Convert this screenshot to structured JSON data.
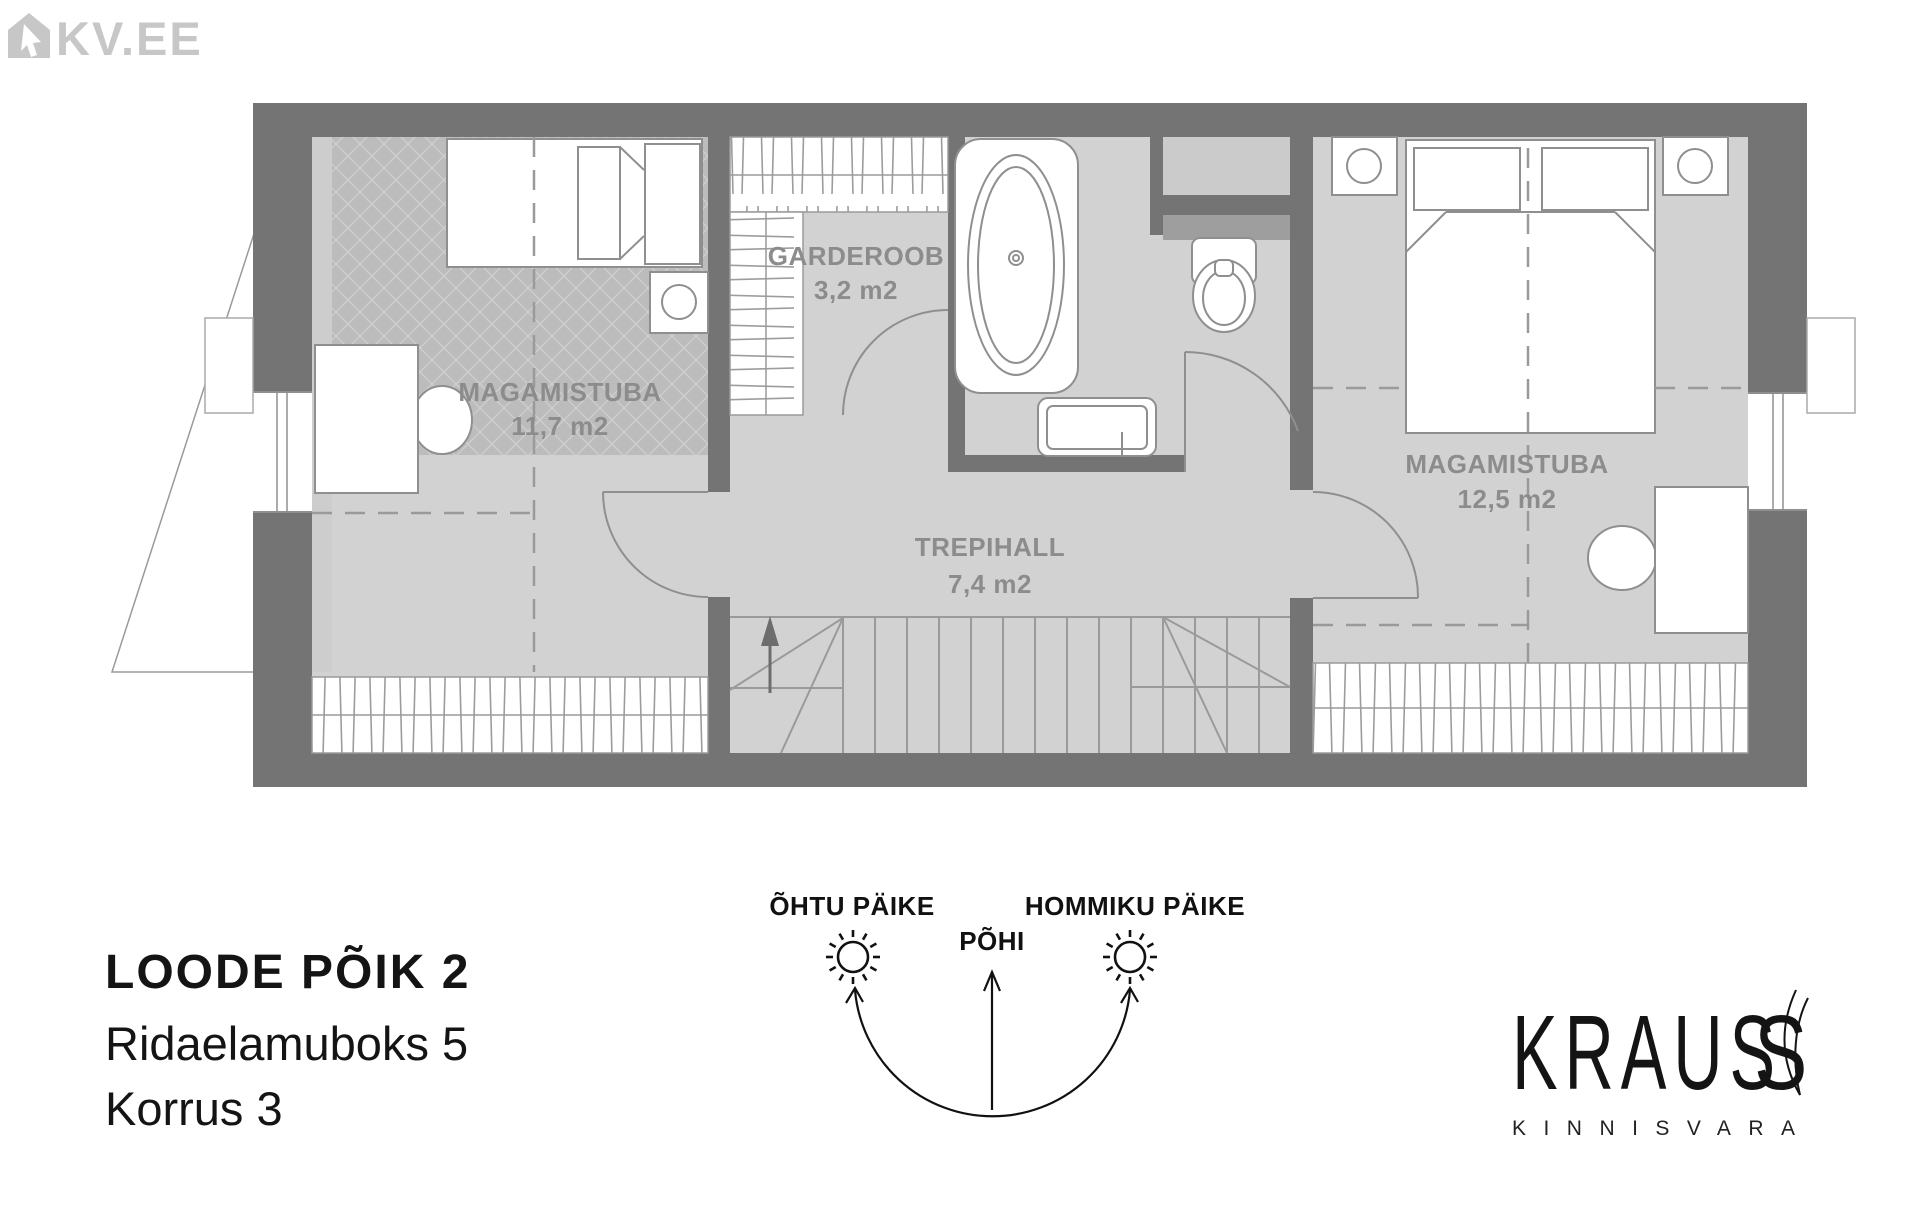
{
  "colors": {
    "wall": "#747474",
    "floor": "#d2d2d2",
    "floor_dark": "#bcbcbc",
    "floor_sliver": "#cdcdcd",
    "niche_floor": "#cbcbcb",
    "band_medium": "#9e9e9e",
    "outline": "#8f8f8f",
    "label": "#8c8c8c",
    "logo_gray": "#c7c7c7",
    "ink": "#141414"
  },
  "logos": {
    "kv": "KV.EE",
    "kraus": "KRAUS",
    "kraus_flourish": "S",
    "kraus_sub": "KINNISVARA"
  },
  "plan": {
    "rooms": [
      {
        "id": "bedroom-1",
        "name": "MAGAMISTUBA",
        "area": "11,7 m2"
      },
      {
        "id": "wardrobe",
        "name": "GARDEROOB",
        "area": "3,2 m2"
      },
      {
        "id": "stair-hall",
        "name": "TREPIHALL",
        "area": "7,4 m2"
      },
      {
        "id": "bedroom-2",
        "name": "MAGAMISTUBA",
        "area": "12,5 m2"
      }
    ]
  },
  "title": {
    "address": "LOODE PÕIK 2",
    "unit": "Ridaelamuboks 5",
    "floor": "Korrus 3"
  },
  "compass": {
    "evening": "ÕHTU PÄIKE",
    "north": "PÕHI",
    "morning": "HOMMIKU PÄIKE"
  }
}
